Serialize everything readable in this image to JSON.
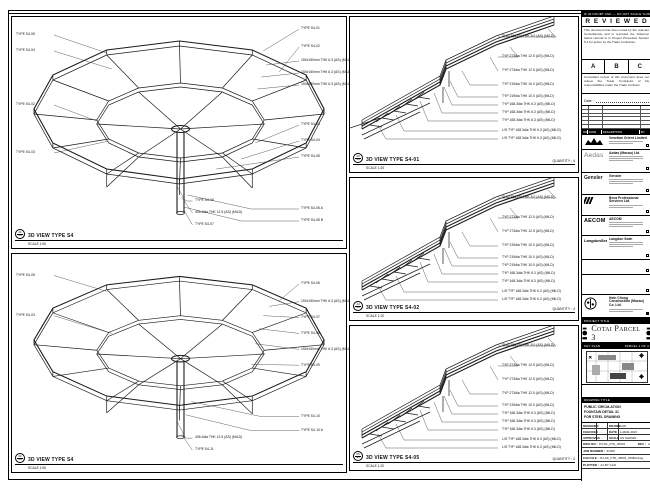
{
  "sheet": {
    "top_note": "IF IN DOUBT ASK — DO NOT SCALE THIS DRAWING — VERIFY ALL DIMENSIONS ON SITE"
  },
  "reviewed": {
    "title": "R E V I E W E D",
    "body": "This document has been noted by the relevant Consultant(s) and is recorded the follow-up status referral to in Project Procedure Section 5.4 for action by the Trade Contractor.",
    "options": [
      "A",
      "B",
      "C"
    ],
    "note": "Consultant review of this document does not relieve the Trade Contractor of his responsibilities under the Trade Contract.",
    "date_label": "Date :"
  },
  "revision": {
    "headers": [
      "NO.",
      "DATE",
      "DESCRIPTION",
      "BY"
    ]
  },
  "companies": {
    "c1": {
      "name": "Venetian Orient Limited"
    },
    "c2": {
      "logo": "Aedas",
      "name": "Aedas (Macau) Ltd."
    },
    "c3": {
      "logo": "Gensler",
      "name": "Gensler"
    },
    "c4": {
      "name": "Beca Professional Services Ltd."
    },
    "c5": {
      "logo": "AECOM",
      "name": "AECOM"
    },
    "c6": {
      "logo": "LangdonSeah",
      "name": "Langdon Seah"
    },
    "c7": {
      "name": "Hsin Chong Construction (Macau) Co. Ltd."
    }
  },
  "project": {
    "bar": "PROJECT TITLE",
    "name": "Cotai Parcel 3"
  },
  "key_plan": {
    "bar": "KEY PLAN",
    "right": "PARCEL 1 OF 3"
  },
  "drawing": {
    "bar": "DRAWING TITLE",
    "line1": "PUBLIC CIRCULATION",
    "line2": "FOUNTAIN DETAIL 31",
    "line3": "FOR STEEL DRAWING"
  },
  "info": {
    "r1l1": "DESIGNED",
    "r1v1": "-",
    "r1l2": "DRAWN",
    "r1v2": "CAD",
    "r2l1": "CHECKED",
    "r2v1": "-",
    "r2l2": "DATE",
    "r2v2": "1-MAR-2016",
    "r3l1": "APPROVED",
    "r3v1": "-",
    "r3l2": "SCALE",
    "r3v2": "AS SHOWN",
    "dwg_label": "DWG NO :",
    "dwg_no": "P3-SK_FTD_45001",
    "rev_label": "REV :",
    "rev": "A",
    "job_label": "JOB NUMBER :",
    "job_no": "31326",
    "cad_label": "CAD FILE :",
    "cad_file": "P3-SK_FTD_45001_S5000.dwg",
    "plot_label": "PLOTTED :",
    "plot": "A1 BY CAD"
  },
  "panels": {
    "top_left": {
      "bubble_no": "21",
      "bubble_ref": "S4",
      "title": "3D VIEW TYPE S4",
      "scale": "SCALE 1:50",
      "left_labels": [
        "TYPE S4-05",
        "TYPE S4-04",
        "TYPE S4-02",
        "TYPE S4-03"
      ],
      "right_labels": [
        "TYPE S4-01",
        "TYPE S4-02",
        "150x150mm THK 6.3 (AS) (MILD)",
        "150x150mm THK 6.3 (AS) (MILD)",
        "150x150mm THK 6.3 (AS) (MILD)",
        "TYPE S4-03",
        "TYPE S4-04",
        "TYPE S4-05",
        "TYPE S4-05 A",
        "TYPE S4-05 B"
      ],
      "bottom_labels": [
        "TYPE S4-06",
        "406.4dia THK 12.5 (AS) (MILD)",
        "TYPE S4-07"
      ]
    },
    "bottom_left": {
      "bubble_no": "22",
      "bubble_ref": "S4",
      "title": "3D VIEW TYPE S4",
      "scale": "SCALE 1:50",
      "left_labels": [
        "TYPE S4-05",
        "TYPE S4-03"
      ],
      "right_labels": [
        "TYPE S4-06",
        "150x150mm THK 6.3 (AS) (MILD)",
        "TYPE S4-07",
        "TYPE S4-08",
        "150x150mm THK 6.3 (AS) (MILD)",
        "TYPE S4-09",
        "TYPE S4-10",
        "TYPE S4-10 A"
      ],
      "bottom_labels": [
        "406.4dia THK 12.5 (AS) (MILD)",
        "TYPE S4-11"
      ]
    },
    "m1": {
      "bubble_no": "23",
      "bubble_ref": "S4",
      "title": "3D VIEW TYPE S4-01",
      "quantity": "QUANTITY : 4",
      "scale": "SCALE 1:20",
      "labels": [
        "SHS150x150 THK 8.0 (AS) (MILD)",
        "TYP 273dia THK 12.5 (AS) (MILD)",
        "TYP 273dia THK 12.5 (AS) (MILD)",
        "TYP 219dia THK 10.0 (AS) (MILD)",
        "TYP 219dia THK 10.0 (AS) (MILD)",
        "TYP 168.3dia THK 6.3 (AS) (MILD)",
        "TYP 168.3dia THK 6.3 (AS) (MILD)",
        "TYP 168.3dia THK 6.3 (AS) (MILD)",
        "L/S TYP 168.3dia THK 6.3 (AS) (MILD)",
        "L/S TYP 168.3dia THK 6.3 (AS) (MILD)"
      ]
    },
    "m2": {
      "bubble_no": "24",
      "bubble_ref": "S4",
      "title": "3D VIEW TYPE S4-02",
      "quantity": "QUANTITY : 4",
      "scale": "SCALE 1:20",
      "labels": [
        "SHS150x150 THK 8.0 (AS) (MILD)",
        "TYP 273dia THK 12.5 (AS) (MILD)",
        "TYP 273dia THK 12.5 (AS) (MILD)",
        "TYP 219dia THK 10.0 (AS) (MILD)",
        "TYP 219dia THK 10.0 (AS) (MILD)",
        "TYP 219dia THK 10.0 (AS) (MILD)",
        "TYP 168.3dia THK 6.3 (AS) (MILD)",
        "TYP 168.3dia THK 6.3 (AS) (MILD)",
        "L/S TYP 168.3dia THK 6.3 (AS) (MILD)",
        "L/S TYP 168.3dia THK 6.3 (AS) (MILD)"
      ]
    },
    "m3": {
      "bubble_no": "26",
      "bubble_ref": "S4",
      "title": "3D VIEW TYPE S4-05",
      "quantity": "QUANTITY : 4",
      "scale": "SCALE 1:20",
      "labels": [
        "SHS150x150 THK 8.0 (AS) (MILD)",
        "TYP 273dia THK 12.5 (AS) (MILD)",
        "TYP 273dia THK 12.5 (AS) (MILD)",
        "TYP 273dia THK 12.5 (AS) (MILD)",
        "TYP 219dia THK 10.0 (AS) (MILD)",
        "TYP 168.3dia THK 6.3 (AS) (MILD)",
        "TYP 168.3dia THK 6.3 (AS) (MILD)",
        "TYP 168.3dia THK 6.3 (AS) (MILD)",
        "L/S TYP 168.3dia THK 6.3 (AS) (MILD)",
        "L/S TYP 168.3dia THK 6.3 (AS) (MILD)"
      ]
    }
  }
}
